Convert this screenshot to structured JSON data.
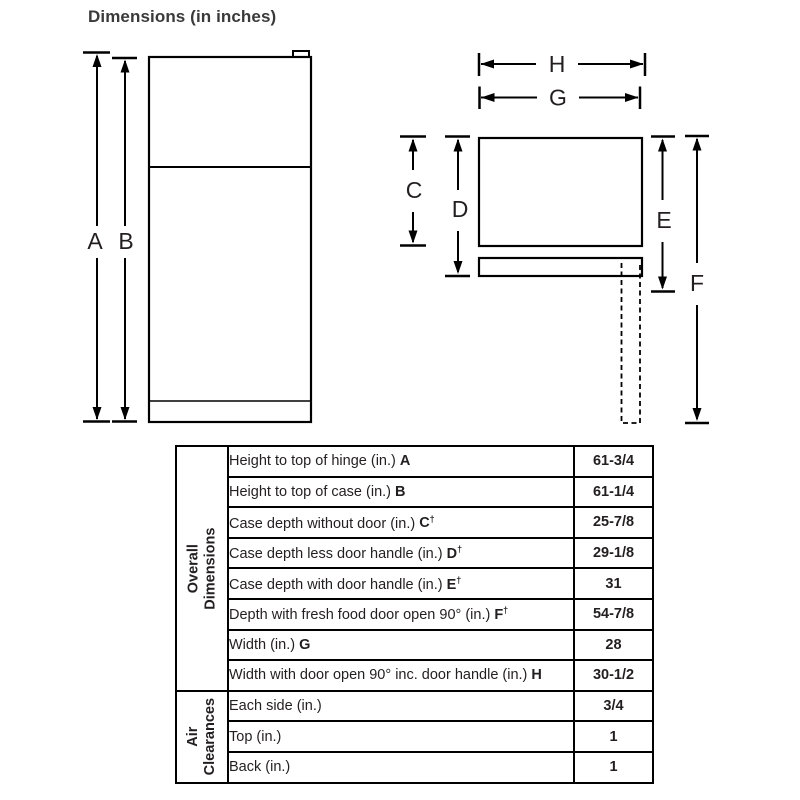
{
  "title": "Dimensions (in inches)",
  "diagram": {
    "front_view": {
      "label_a": "A",
      "label_b": "B"
    },
    "top_view": {
      "label_c": "C",
      "label_d": "D",
      "label_e": "E",
      "label_f": "F",
      "label_g": "G",
      "label_h": "H"
    }
  },
  "table": {
    "groups": [
      {
        "label": "Overall\nDimensions",
        "rows": [
          {
            "label": "Height to top of hinge (in.)",
            "letter": "A",
            "value": "61-3/4"
          },
          {
            "label": "Height to top of case (in.)",
            "letter": "B",
            "value": "61-1/4"
          },
          {
            "label": "Case depth without door (in.)",
            "letter": "C",
            "dagger": "†",
            "value": "25-7/8"
          },
          {
            "label": "Case depth less door handle (in.)",
            "letter": "D",
            "dagger": "†",
            "value": "29-1/8"
          },
          {
            "label": "Case depth with door handle (in.)",
            "letter": "E",
            "dagger": "†",
            "value": "31"
          },
          {
            "label": "Depth with fresh food door open 90° (in.)",
            "letter": "F",
            "dagger": "†",
            "value": "54-7/8"
          },
          {
            "label": "Width (in.)",
            "letter": "G",
            "value": "28"
          },
          {
            "label": "Width with door open 90° inc. door handle (in.)",
            "letter": "H",
            "value": "30-1/2"
          }
        ]
      },
      {
        "label": "Air\nClearances",
        "rows": [
          {
            "label": "Each side (in.)",
            "value": "3/4"
          },
          {
            "label": "Top (in.)",
            "value": "1"
          },
          {
            "label": "Back (in.)",
            "value": "1"
          }
        ]
      }
    ]
  },
  "colors": {
    "line": "#000000",
    "text": "#231f20"
  }
}
